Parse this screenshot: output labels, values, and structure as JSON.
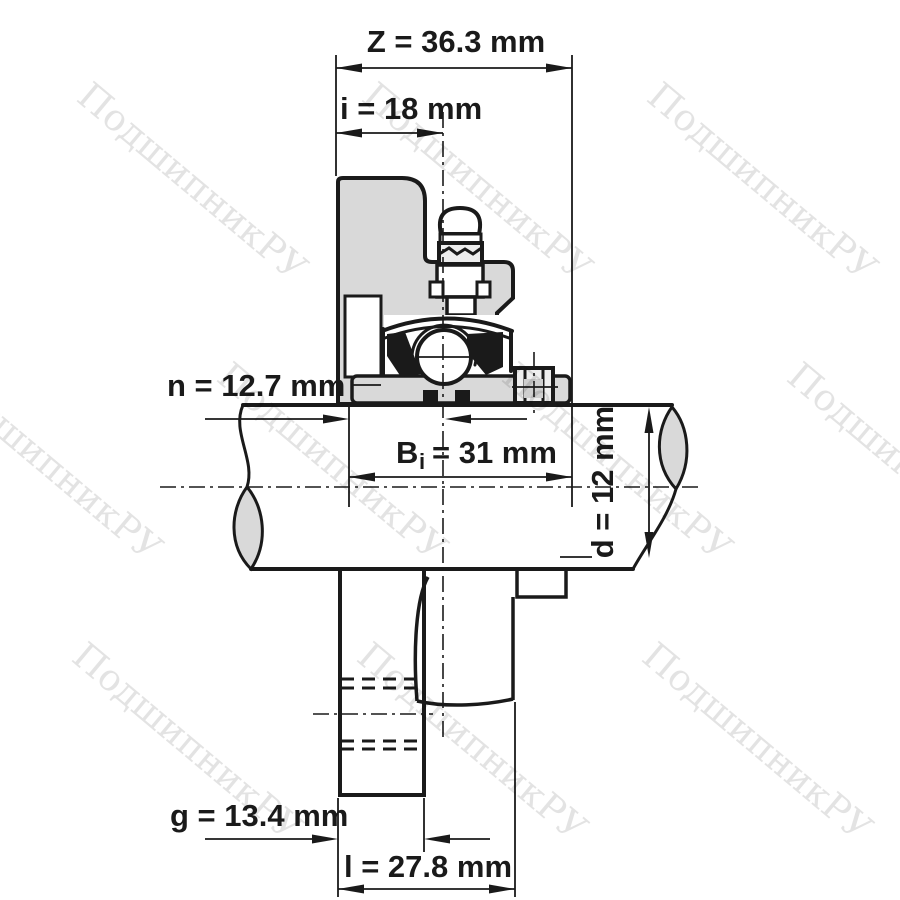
{
  "drawing": {
    "title": "bearing-unit-cross-section",
    "dimensions": {
      "z": "Z = 36.3 mm",
      "i": "i = 18 mm",
      "n": "n = 12.7 mm",
      "bi_prefix": "B",
      "bi_sub": "i",
      "bi_rest": "= 31 mm",
      "d": "d = 12 mm",
      "g": "g = 13.4 mm",
      "l": "l = 27.8 mm"
    },
    "watermark": {
      "text": "ПодшипникРУ"
    },
    "colors": {
      "line": "#1a1a1a",
      "fill": "#d9d9d9",
      "watermark": "rgba(0,0,0,0.11)",
      "background": "#ffffff"
    }
  }
}
